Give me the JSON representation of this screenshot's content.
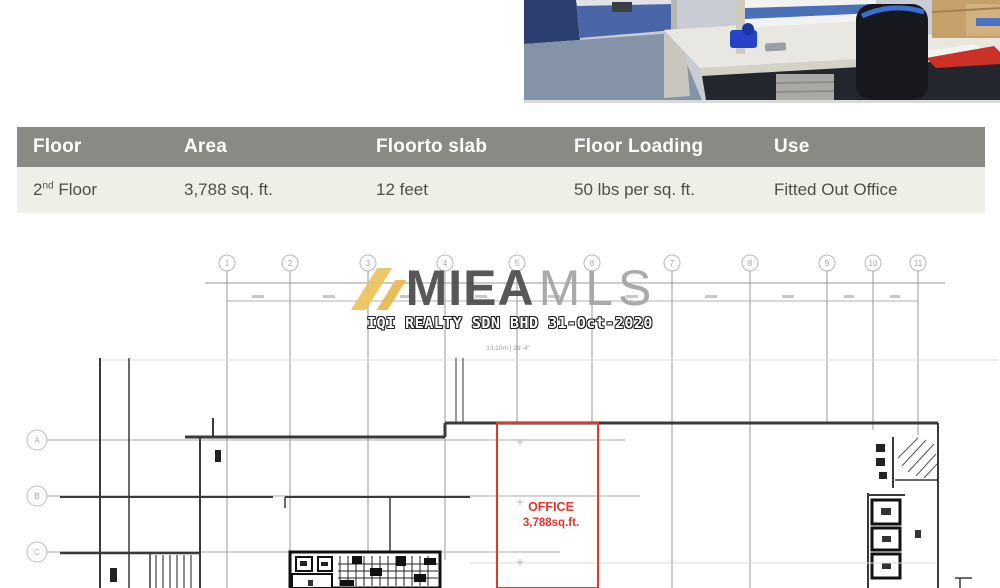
{
  "photo": {
    "name": "office-interior-photo"
  },
  "table": {
    "headers": [
      "Floor",
      "Area",
      "Floorto slab",
      "Floor Loading",
      "Use"
    ],
    "row": {
      "floor_base": "2",
      "floor_ordinal": "nd",
      "floor_rest": " Floor",
      "area": "3,788 sq. ft.",
      "floor_to_slab": "12 feet",
      "floor_loading": "50 lbs per sq. ft.",
      "use": "Fitted Out Office"
    }
  },
  "watermark": {
    "brand_bold": "MIEA",
    "brand_light": "MLS",
    "subtitle": "IQI REALTY SDN BHD 31-Oct-2020"
  },
  "plan": {
    "columns": [
      "1",
      "2",
      "3",
      "4",
      "5",
      "6",
      "7",
      "8",
      "9",
      "10",
      "11"
    ],
    "rows": [
      "A",
      "B",
      "C"
    ],
    "office": {
      "label": "OFFICE",
      "area": "3,788sq.ft."
    },
    "dimension_note": "13.10m | 29'-4\""
  },
  "colors": {
    "table_header_bg": "#8a8a85",
    "table_row_bg": "#eef0e7",
    "accent_red": "#e0382f",
    "watermark_gold": "#ecc35f"
  }
}
